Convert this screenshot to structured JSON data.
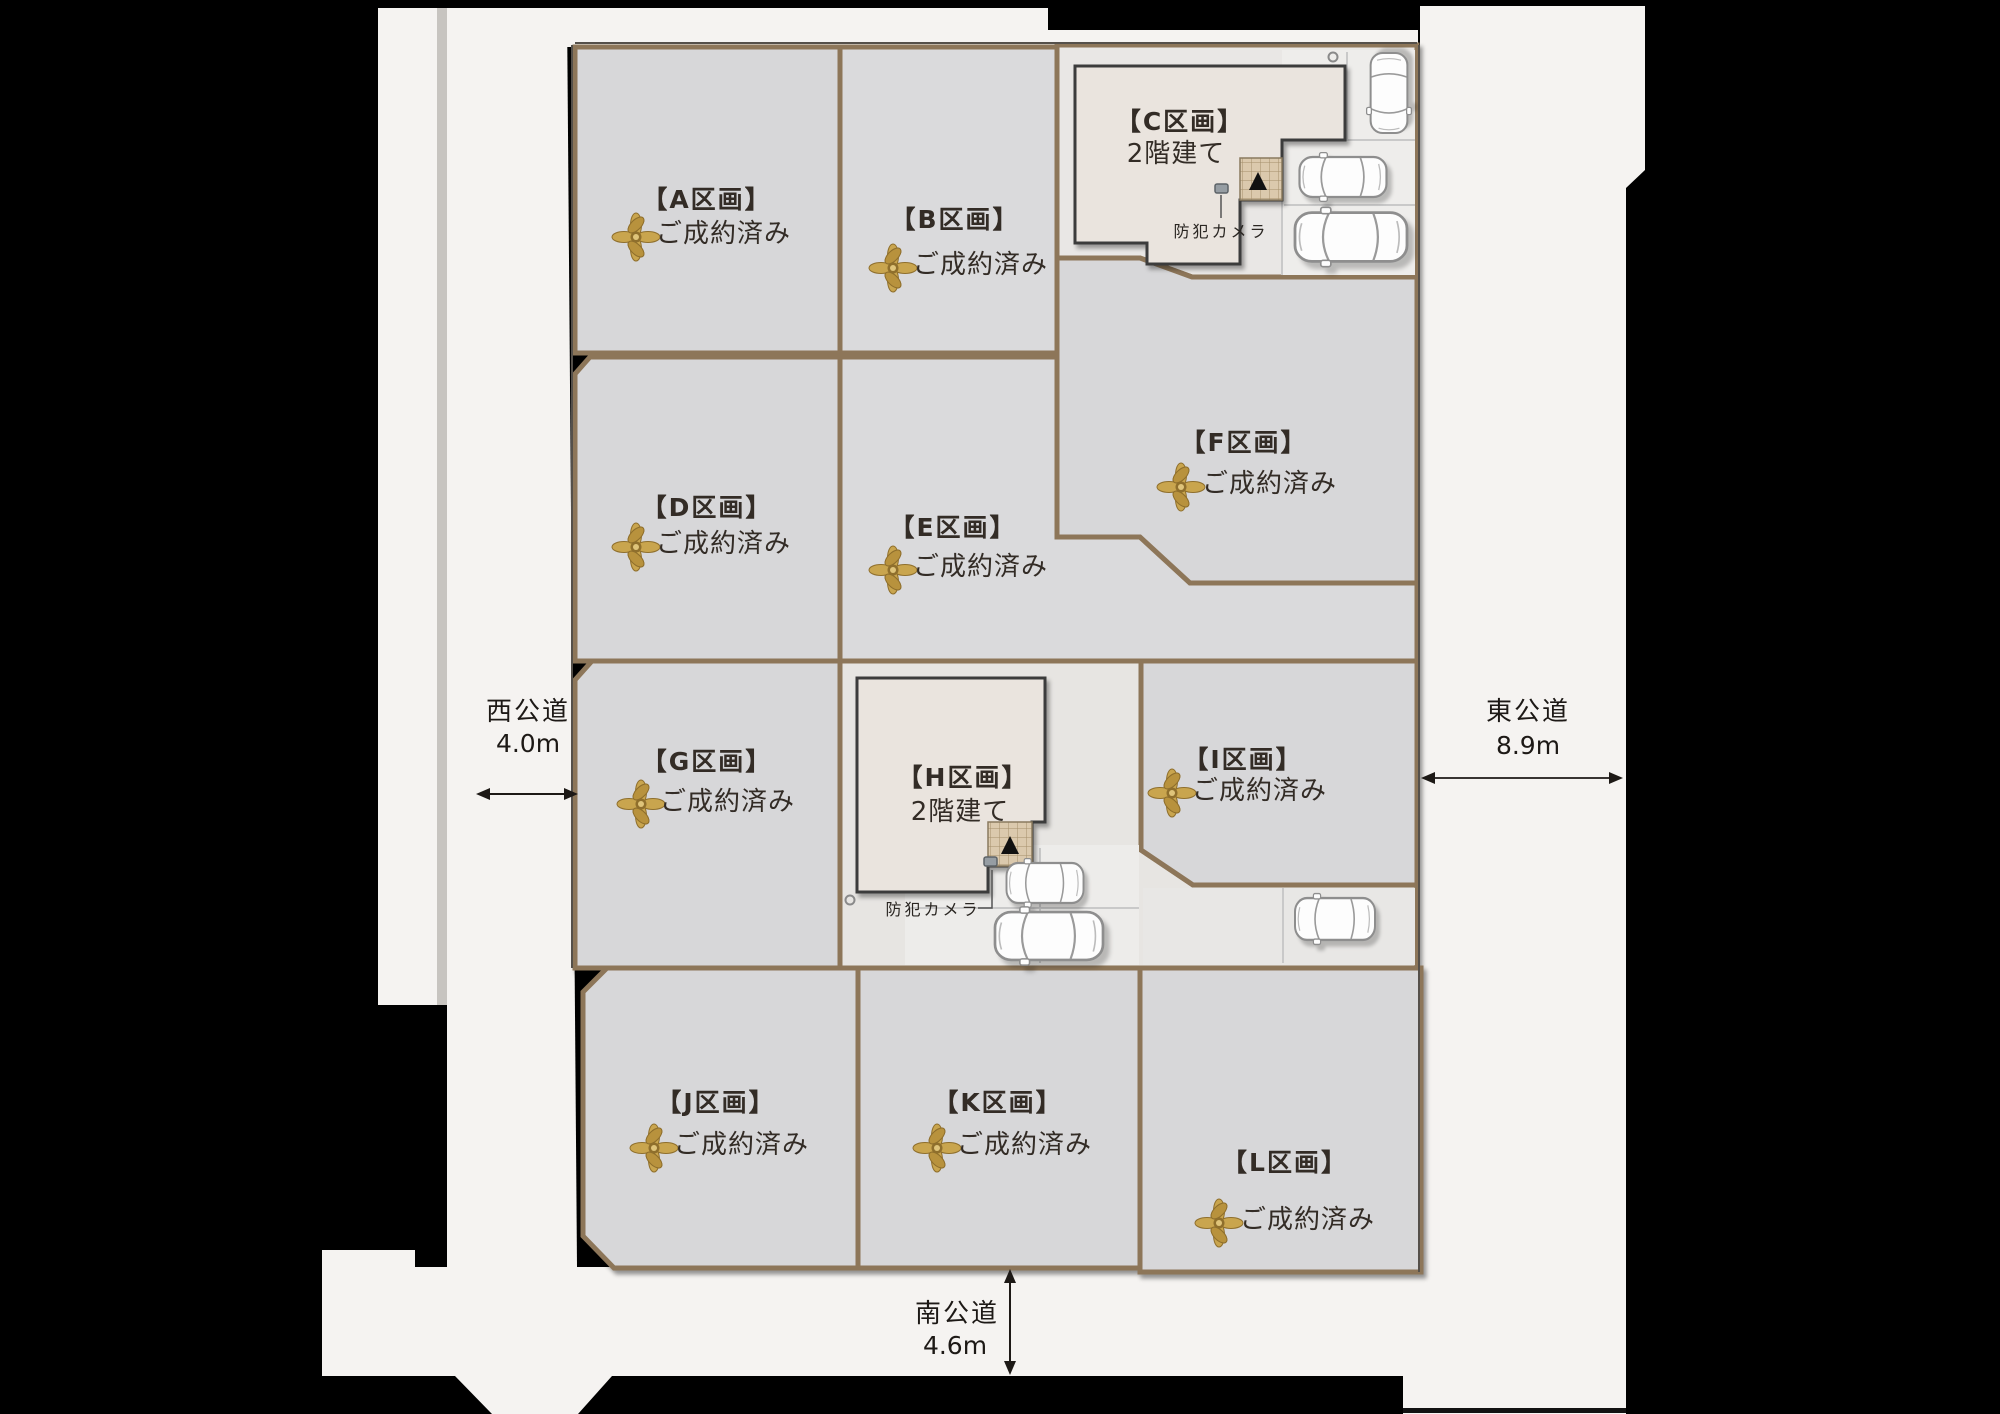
{
  "doc_title": "区画図",
  "labels": {
    "security_camera": "防犯カメラ",
    "sold_ribbon_icon": "gold-bow",
    "status_sold": "ご成約済み",
    "two_story": "2階建て"
  },
  "colors": {
    "background": "#000000",
    "road": "#f5f3f1",
    "lot_fill": "#d7d7d9",
    "lot_border": "#8d7659",
    "house_fill": "#eae4de",
    "house_outline": "#3c3c3c",
    "porch_tile": "#dbc9ad",
    "ribbon_gold": "#c9a54e",
    "text_dark": "#332c26"
  },
  "roads": {
    "west": {
      "name": "西公道",
      "width": "4.0m"
    },
    "east": {
      "name": "東公道",
      "width": "8.9m"
    },
    "south": {
      "name": "南公道",
      "width": "4.6m"
    }
  },
  "lots": [
    {
      "id": "A",
      "name": "【A区画】",
      "status": "ご成約済み",
      "sold": true
    },
    {
      "id": "B",
      "name": "【B区画】",
      "status": "ご成約済み",
      "sold": true
    },
    {
      "id": "C",
      "name": "【C区画】",
      "floors": "2階建て",
      "sold": false
    },
    {
      "id": "D",
      "name": "【D区画】",
      "status": "ご成約済み",
      "sold": true
    },
    {
      "id": "E",
      "name": "【E区画】",
      "status": "ご成約済み",
      "sold": true
    },
    {
      "id": "F",
      "name": "【F区画】",
      "status": "ご成約済み",
      "sold": true
    },
    {
      "id": "G",
      "name": "【G区画】",
      "status": "ご成約済み",
      "sold": true
    },
    {
      "id": "H",
      "name": "【H区画】",
      "floors": "2階建て",
      "sold": false
    },
    {
      "id": "I",
      "name": "【I区画】",
      "status": "ご成約済み",
      "sold": true
    },
    {
      "id": "J",
      "name": "【J区画】",
      "status": "ご成約済み",
      "sold": true
    },
    {
      "id": "K",
      "name": "【K区画】",
      "status": "ご成約済み",
      "sold": true
    },
    {
      "id": "L",
      "name": "【L区画】",
      "status": "ご成約済み",
      "sold": true
    }
  ]
}
